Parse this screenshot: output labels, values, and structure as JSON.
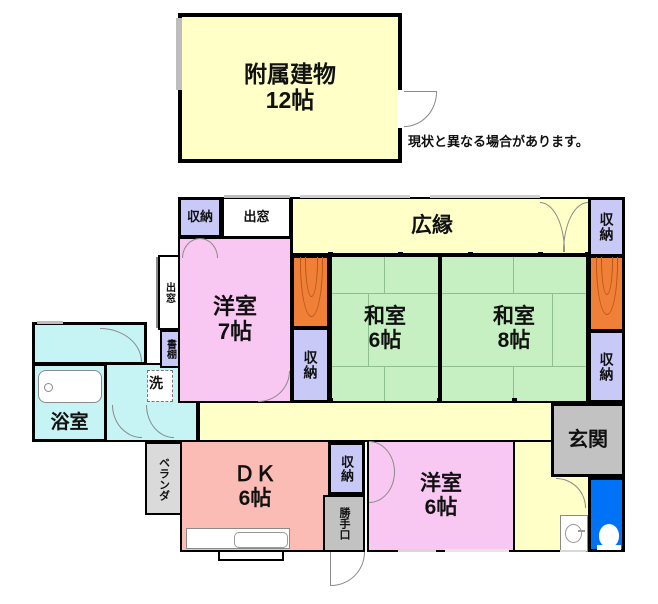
{
  "note": "現状と異なる場合があります。",
  "annex": {
    "name": "附属建物",
    "size": "12帖"
  },
  "rooms": {
    "hiroen": "広縁",
    "washitsu6_name": "和室",
    "washitsu6_size": "6帖",
    "washitsu8_name": "和室",
    "washitsu8_size": "8帖",
    "yoshitsu7_name": "洋室",
    "yoshitsu7_size": "7帖",
    "yoshitsu6_name": "洋室",
    "yoshitsu6_size": "6帖",
    "dk_name": "ＤＫ",
    "dk_size": "6帖",
    "genkan": "玄関",
    "yokushitsu": "浴室",
    "closet": "収納",
    "demado": "出窓",
    "shodana": "書棚",
    "laundry": "洗",
    "veranda": "ベランダ",
    "katteguchi": "勝手口"
  },
  "colors": {
    "yellow": "#FFFFC8",
    "green": "#C6F0C2",
    "pink": "#F8C8F2",
    "salmon": "#FABCB4",
    "cyan": "#C6F4F4",
    "lavender": "#C9C9F8",
    "orange": "#F08038",
    "gray": "#C2C2C2",
    "lightgray": "#DADADA",
    "blue": "#0072F5"
  }
}
